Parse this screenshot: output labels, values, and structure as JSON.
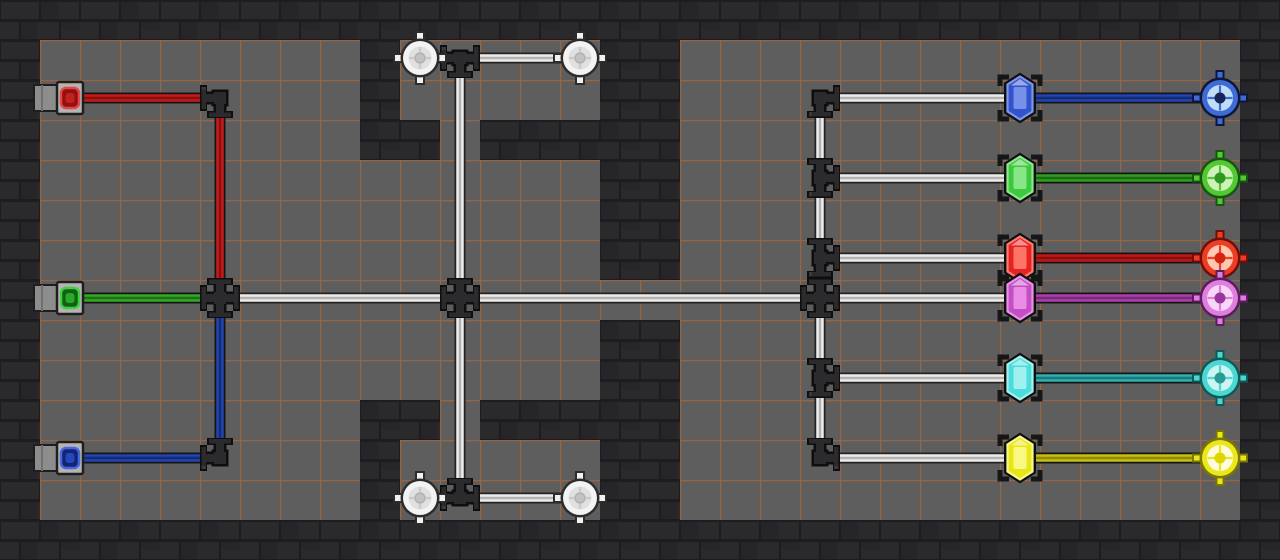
{
  "scene": {
    "kind": "pipe-network-puzzle-board",
    "width_px": 1280,
    "height_px": 560,
    "grid_cell_px": 40,
    "visible_text": "none"
  },
  "palette": {
    "vars": "--pwf:#ededed;--pwc:#b2b2b2;--floor:#5e5e5e;--grid:#b96a35;--brick-bg:#1d1d20;--brick:#2a2a2d;--brick-alt:#26262a",
    "floor": "#5e5e5e",
    "grid_line": "#b96a35",
    "brick": "#2a2a2d",
    "brick_mortar": "#1d1d20",
    "white_pipe": "#ededed",
    "white_pipe_core": "#b2b2b2",
    "fitting_body": "#2b2b2e",
    "fitting_outline": "#0e0e0f",
    "valve_wheel": "#f3f3f3"
  },
  "inputs": {
    "red": {
      "id": "red-inlet",
      "color": "#c41c1c",
      "vars": "--pipe:#c41c1c;--core:#8a0f0f;--ia:#e84545;--ib:#8f1212;--ic:#c32020"
    },
    "green": {
      "id": "green-inlet",
      "color": "#35a828",
      "vars": "--pipe:#35a828;--core:#1d7014;--ia:#3fd03f;--ib:#135f13;--ic:#2aa82a"
    },
    "blue": {
      "id": "blue-inlet",
      "color": "#2444b2",
      "vars": "--pipe:#2444b2;--core:#142c74;--ia:#4767e0;--ib:#14246e;--ic:#2547c0"
    }
  },
  "outputs": {
    "blue": {
      "id": "blue-output",
      "gem": "#3353cc",
      "port": "#3e6cd6",
      "vars": "--pipe:#2444b2;--core:#142c74;--ring:#3e6cd6;--inner:#bfdcf8;--dot:#182457;--edge:#10163a;--gem:#3353cc;--lite:#7d97ea"
    },
    "green": {
      "id": "green-output",
      "gem": "#3ec83e",
      "port": "#52c833",
      "vars": "--pipe:#2f9e22;--core:#1c6a12;--ring:#52c833;--inner:#cff2bb;--dot:#2f9623;--edge:#175510;--gem:#3ec83e;--lite:#8ee88e"
    },
    "red": {
      "id": "red-output",
      "gem": "#e62222",
      "port": "#ef3d25",
      "vars": "--pipe:#c01818;--core:#870e0e;--ring:#ef3d25;--inner:#ffc8b0;--dot:#d62211;--edge:#6e0f08;--gem:#e62222;--lite:#ff7d6e"
    },
    "magenta": {
      "id": "magenta-output",
      "gem": "#c44fc4",
      "port": "#e07ee0",
      "vars": "--pipe:#ad3fad;--core:#772a77;--ring:#e07ee0;--inner:#f7d7f7;--dot:#97379b;--edge:#5c1d60;--gem:#c44fc4;--lite:#eb92e8"
    },
    "cyan": {
      "id": "cyan-output",
      "gem": "#4cdcdc",
      "port": "#4cd8d2",
      "vars": "--pipe:#2fb0b0;--core:#1d7878;--ring:#4cd8d2;--inner:#ccf4f2;--dot:#2a9a94;--edge:#0f5a56;--gem:#4cdcdc;--lite:#a5f2ef"
    },
    "yellow": {
      "id": "yellow-output",
      "gem": "#e6e618",
      "port": "#ebe71d",
      "vars": "--pipe:#c6c00f;--core:#8f8a00;--ring:#ebe71d;--inner:#fffbdc;--dot:#dcd500;--edge:#7a7600;--gem:#e6e618;--lite:#fafa8c"
    }
  },
  "valves": [
    "top-left-valve",
    "top-right-valve",
    "bottom-left-valve",
    "bottom-right-valve"
  ]
}
